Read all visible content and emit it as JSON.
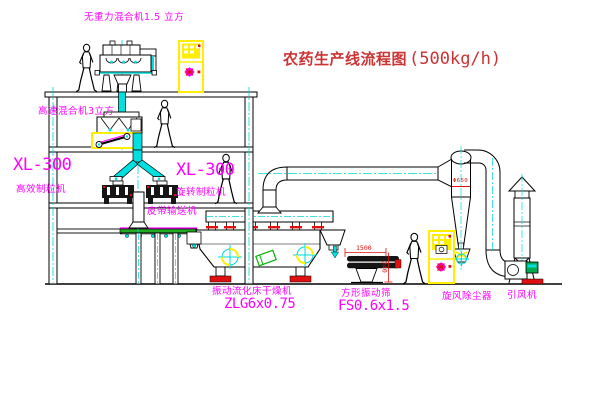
{
  "title": {
    "main": "农药生产线流程图",
    "capacity": "(500kg/h)"
  },
  "labels": {
    "zero_gravity_mixer": "无重力混合机1.5 立方",
    "high_speed_mixer": "高速混合机3立方",
    "granulator_left_model": "XL-300",
    "granulator_left_name": "高效制粒机",
    "granulator_center_model": "XL-300",
    "granulator_center_name": "旋转制粒机",
    "belt_conveyor": "皮带输送机",
    "dryer_name": "振动流化床干燥机",
    "dryer_model": "ZLG6x0.75",
    "sieve_name": "方形振动筛",
    "sieve_model": "FS0.6x1.5",
    "cyclone": "旋风除尘器",
    "induced_draft_fan": "引风机"
  },
  "dims": {
    "sieve_length": "1500",
    "sieve_height": "340",
    "cyclone_diameter": "Φ650"
  },
  "colors": {
    "label_magenta": "#ff00ff",
    "title_red": "#cc3333",
    "dimension_red": "#e01010",
    "centerline_cyan": "#00d8d8",
    "pipe_fill_cyan": "#00e0e0",
    "cabinet_yellow": "#ffee00",
    "conveyor_green": "#22aa22",
    "line_black": "#000000"
  }
}
